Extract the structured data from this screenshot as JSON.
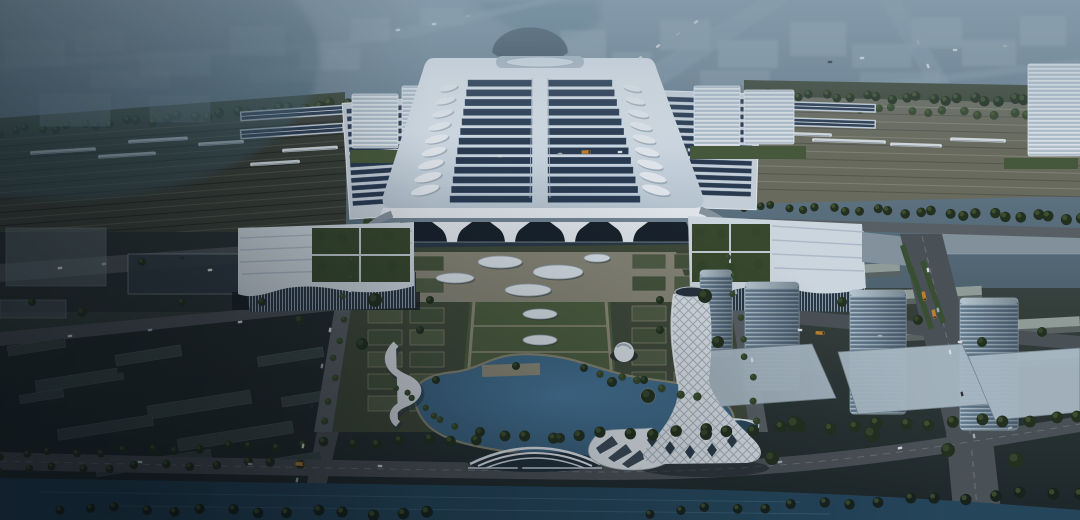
{
  "scene": {
    "label": "Aerial dusk rendering of a high-speed railway station: solar-panel hall roof, platform canopies with trains, formal forecourt gardens, lakeside park with spiral lattice tower, glass office towers and canal"
  },
  "palette": {
    "corridorL": "#3c4037",
    "corridorR": "#6f6f60",
    "trackA": "#5b5f50",
    "trackB": "#23261f",
    "trackC": "#8e8e7d",
    "trackD": "#57574b",
    "treeDark": "#24301d",
    "treeMid": "#36472a",
    "treeDeep": "#17211a",
    "roofLight": "#eef2f7",
    "roofShade": "#c2cfda",
    "panelDark": "#2b3b51",
    "panelLight": "#3d5472",
    "canopyFrame": "#d2dbe4",
    "fascia": "#eef2f6",
    "facadeDark": "#18212a",
    "glassDark": "#2a3845",
    "plazaBase": "#424b38",
    "hedge": "#535f44",
    "lawn": "#47553b",
    "pathTan": "#948e7a",
    "apron": "#8e8a79",
    "axisLawn": "#50603f",
    "ovalWhite": "#e4ebf0",
    "ovalRim": "#9aa8b2",
    "canal": "#26475c",
    "road": "#4e5357",
    "roadLight": "#5d6367",
    "lane": "#8f969b",
    "bldGrey": "#9aa49e",
    "bldGreySide": "#5d6763",
    "towerLight": "#c3d2db",
    "twist": "#e6ebf0",
    "lattice": "#8b98a4",
    "annexRoof": "#dbe3ea",
    "annexStripe": "#b9c6d3",
    "court": "#3a4a2c",
    "districtBox": "#3d4846",
    "districtBoxSide": "#242c2c",
    "carW": "#e2e7ea",
    "carS": "#aab4ba",
    "carD": "#2c3338",
    "bus": "#c8872f",
    "trainBody": "#dfe5e9",
    "trainLine": "#8b95a0",
    "bgBlock": "#a7b6c0",
    "bgRoad": "#8da2af",
    "shore": "#8d8a74"
  },
  "background": {
    "blocks": [
      [
        5,
        40,
        60,
        26,
        0.3
      ],
      [
        75,
        30,
        50,
        22,
        0.25
      ],
      [
        140,
        52,
        70,
        24,
        0.3
      ],
      [
        230,
        26,
        55,
        30,
        0.35
      ],
      [
        300,
        48,
        60,
        22,
        0.28
      ],
      [
        350,
        18,
        40,
        24,
        0.3
      ],
      [
        90,
        70,
        80,
        18,
        0.22
      ],
      [
        250,
        66,
        70,
        16,
        0.2
      ],
      [
        560,
        30,
        46,
        34,
        0.4
      ],
      [
        612,
        52,
        40,
        26,
        0.35
      ],
      [
        660,
        20,
        50,
        30,
        0.38
      ],
      [
        718,
        40,
        60,
        28,
        0.42
      ],
      [
        790,
        22,
        56,
        34,
        0.4
      ],
      [
        852,
        44,
        60,
        24,
        0.35
      ],
      [
        912,
        18,
        50,
        30,
        0.4
      ],
      [
        962,
        40,
        54,
        26,
        0.38
      ],
      [
        1020,
        16,
        46,
        30,
        0.4
      ],
      [
        700,
        70,
        70,
        16,
        0.3
      ],
      [
        860,
        72,
        80,
        14,
        0.28
      ],
      [
        420,
        8,
        44,
        18,
        0.3
      ]
    ],
    "roads": [
      "0,62 360,40 360,46 0,70",
      "370,34 540,0 560,0 400,40",
      "600,96 760,0 790,0 640,100",
      "640,112 1080,58 1080,66 660,116",
      "900,0 960,100 940,104 880,0"
    ]
  },
  "railway": {
    "trains": [
      [
        30,
        151,
        66,
        -3.5
      ],
      [
        98,
        155,
        58,
        -3.5
      ],
      [
        128,
        140,
        60,
        -3.5
      ],
      [
        198,
        143,
        46,
        -3.5
      ],
      [
        250,
        163,
        50,
        -3.5
      ],
      [
        282,
        149,
        56,
        -3.5
      ],
      [
        733,
        128,
        56,
        1.8
      ],
      [
        762,
        134,
        70,
        1.8
      ],
      [
        812,
        141,
        74,
        1.8
      ],
      [
        890,
        145,
        52,
        1.8
      ],
      [
        950,
        140,
        56,
        1.8
      ]
    ]
  },
  "station": {
    "roof_grid": {
      "rows": 13,
      "yTop": 80,
      "yBot": 196,
      "rowH": 6.4,
      "leftTop": 468,
      "leftBot": 450,
      "rightTop": 612,
      "rightBot": 640,
      "cx": 540,
      "spine": 8
    },
    "leaf": {
      "n": 9,
      "rx": 12,
      "ry": 3.6,
      "left": [
        448,
        88,
        425,
        190,
        -14
      ],
      "right": [
        632,
        88,
        656,
        190,
        14
      ]
    },
    "canopies": [
      {
        "x": 350,
        "y": 106,
        "w": 90,
        "rows": 13,
        "rowH": 4.4,
        "gap": 3.3,
        "rot": -3.8,
        "fx": 346,
        "fy": 100,
        "fw": 98,
        "fh": 116
      },
      {
        "x": 648,
        "y": 98,
        "w": 104,
        "rows": 13,
        "rowH": 4.4,
        "gap": 3.3,
        "rot": 1.8,
        "fx": 644,
        "fy": 92,
        "fw": 114,
        "fh": 116
      }
    ],
    "outer_strips": [
      [
        240,
        108,
        104,
        10,
        -3.8
      ],
      [
        240,
        126,
        104,
        10,
        -3.8
      ],
      [
        758,
        102,
        118,
        9,
        1.8
      ],
      [
        758,
        118,
        118,
        9,
        1.8
      ]
    ],
    "flank_slabs": [
      [
        352,
        94,
        46,
        54
      ],
      [
        402,
        86,
        42,
        62
      ],
      [
        694,
        86,
        46,
        60
      ],
      [
        744,
        90,
        50,
        54
      ],
      [
        1028,
        64,
        54,
        92
      ]
    ],
    "lawns": [
      [
        350,
        150,
        112,
        13
      ],
      [
        690,
        146,
        116,
        13
      ],
      [
        1004,
        158,
        74,
        11
      ]
    ],
    "pylons": [
      452,
      510,
      570,
      628
    ]
  },
  "plaza": {
    "ovals": [
      [
        500,
        262,
        22,
        6
      ],
      [
        558,
        272,
        25,
        7
      ],
      [
        455,
        278,
        19,
        5
      ],
      [
        528,
        290,
        23,
        6
      ],
      [
        597,
        258,
        13,
        4
      ]
    ],
    "axis_ovals": [
      [
        540,
        314,
        17,
        5
      ],
      [
        540,
        340,
        17,
        5
      ],
      [
        540,
        366,
        17,
        5
      ]
    ],
    "gardens": [
      [
        368,
        308,
        2,
        5
      ],
      [
        632,
        306,
        2,
        5
      ],
      [
        368,
        256,
        2,
        2
      ],
      [
        632,
        254,
        2,
        2
      ]
    ],
    "cell": {
      "cw": 34,
      "ch": 15,
      "gx": 8,
      "gy": 7
    }
  },
  "district": {
    "towers": [
      [
        700,
        270,
        32,
        86
      ],
      [
        745,
        282,
        54,
        108
      ],
      [
        850,
        290,
        56,
        124
      ],
      [
        960,
        298,
        58,
        132
      ]
    ],
    "podiums": [
      "688,352 812,344 836,398 700,408",
      "838,352 962,344 990,404 858,414",
      "968,356 1080,348 1080,412 995,420"
    ],
    "rows_ne": [
      [
        664,
        246,
        190,
        12
      ],
      [
        690,
        268,
        210,
        13
      ],
      [
        742,
        292,
        240,
        14
      ],
      [
        860,
        322,
        220,
        15
      ],
      [
        950,
        352,
        130,
        14
      ]
    ],
    "boxes_sw": [
      [
        36,
        374,
        88,
        20
      ],
      [
        116,
        350,
        66,
        18
      ],
      [
        148,
        398,
        104,
        22
      ],
      [
        58,
        422,
        96,
        18
      ],
      [
        178,
        430,
        116,
        20
      ],
      [
        258,
        352,
        66,
        16
      ],
      [
        282,
        392,
        70,
        16
      ],
      [
        8,
        342,
        58,
        16
      ],
      [
        96,
        458,
        116,
        16
      ],
      [
        236,
        458,
        86,
        14
      ],
      [
        20,
        392,
        44,
        14
      ]
    ],
    "midleft": [
      [
        6,
        228,
        100,
        58,
        "#6b7a80",
        0.55
      ],
      [
        128,
        254,
        148,
        40,
        "#323d44",
        0.9
      ],
      [
        0,
        300,
        66,
        18,
        "#55636a",
        0.6
      ],
      [
        40,
        94,
        70,
        32,
        "#8ca0ac",
        0.4
      ],
      [
        150,
        96,
        60,
        26,
        "#8ca0ac",
        0.3
      ],
      [
        940,
        230,
        148,
        24,
        "#97a3ab",
        0.8
      ]
    ],
    "medians": [
      "908,268 913,266 934,328 929,330",
      "920,262 925,260 946,322 941,324",
      "900,246 905,244 914,272 909,274"
    ]
  },
  "greenery": {
    "bands_north": [
      [
        0,
        132,
        346,
        104,
        26,
        5,
        "#24301d"
      ],
      [
        744,
        94,
        1080,
        102,
        26,
        5,
        "#24301d"
      ],
      [
        860,
        108,
        1080,
        118,
        14,
        5,
        "#36472a"
      ],
      [
        744,
        206,
        1080,
        218,
        24,
        5,
        "#24301d"
      ]
    ],
    "bands_south": [
      [
        0,
        455,
        1080,
        418,
        44,
        5,
        "#24301d"
      ],
      [
        0,
        470,
        300,
        462,
        12,
        5,
        "#24301d"
      ],
      [
        60,
        508,
        430,
        514,
        14,
        6,
        "#17211a"
      ],
      [
        650,
        512,
        1080,
        492,
        16,
        6,
        "#17211a"
      ],
      [
        352,
        258,
        326,
        420,
        9,
        4,
        "#36472a"
      ],
      [
        728,
        255,
        758,
        420,
        9,
        4,
        "#36472a"
      ],
      [
        396,
        386,
        452,
        428,
        7,
        4,
        "#36472a"
      ],
      [
        600,
        372,
        700,
        398,
        6,
        5,
        "#36472a"
      ]
    ],
    "clusters_north": [
      [
        366,
        156,
        3
      ],
      [
        398,
        156,
        3
      ],
      [
        700,
        152,
        3
      ],
      [
        736,
        152,
        3
      ],
      [
        760,
        152,
        3
      ],
      [
        430,
        158,
        3
      ],
      [
        368,
        222,
        5
      ],
      [
        712,
        218,
        5
      ]
    ],
    "clusters_south": [
      [
        375,
        300,
        7
      ],
      [
        705,
        296,
        7
      ],
      [
        362,
        344,
        6
      ],
      [
        718,
        342,
        6
      ],
      [
        648,
        396,
        7
      ],
      [
        612,
        382,
        5
      ],
      [
        795,
        424,
        8
      ],
      [
        706,
        434,
        6
      ],
      [
        872,
        434,
        8
      ],
      [
        948,
        450,
        7
      ],
      [
        1016,
        460,
        8
      ],
      [
        772,
        458,
        7
      ],
      [
        842,
        302,
        5
      ],
      [
        918,
        320,
        5
      ],
      [
        300,
        320,
        5
      ],
      [
        262,
        302,
        4
      ],
      [
        182,
        302,
        4
      ],
      [
        82,
        312,
        5
      ],
      [
        32,
        302,
        4
      ],
      [
        142,
        262,
        4
      ],
      [
        982,
        342,
        5
      ],
      [
        1042,
        332,
        5
      ],
      [
        480,
        432,
        5
      ],
      [
        560,
        438,
        5
      ],
      [
        430,
        300,
        4
      ],
      [
        660,
        300,
        4
      ],
      [
        516,
        366,
        4
      ],
      [
        584,
        368,
        4
      ],
      [
        420,
        330,
        4
      ],
      [
        436,
        380,
        4
      ],
      [
        660,
        330,
        4
      ],
      [
        644,
        380,
        4
      ]
    ]
  },
  "traffic": {
    "cars": [
      [
        398,
        30,
        -8,
        "w"
      ],
      [
        434,
        24,
        -8,
        "w"
      ],
      [
        468,
        16,
        -8,
        "s"
      ],
      [
        640,
        58,
        -35,
        "w"
      ],
      [
        658,
        46,
        -35,
        "w"
      ],
      [
        678,
        34,
        -35,
        "s"
      ],
      [
        696,
        22,
        -35,
        "w"
      ],
      [
        830,
        62,
        -4,
        "d"
      ],
      [
        862,
        58,
        -4,
        "w"
      ],
      [
        918,
        42,
        70,
        "s"
      ],
      [
        928,
        66,
        70,
        "w"
      ],
      [
        955,
        50,
        -4,
        "w"
      ],
      [
        1005,
        46,
        -4,
        "s"
      ],
      [
        500,
        156,
        -2,
        "w"
      ],
      [
        560,
        154,
        -2,
        "s"
      ],
      [
        620,
        152,
        -2,
        "w"
      ],
      [
        60,
        268,
        -5,
        "w"
      ],
      [
        104,
        264,
        -5,
        "s"
      ],
      [
        182,
        258,
        -5,
        "d"
      ],
      [
        262,
        252,
        -5,
        "w"
      ],
      [
        210,
        270,
        -5,
        "w"
      ],
      [
        330,
        330,
        -80,
        "w"
      ],
      [
        322,
        366,
        -80,
        "s"
      ],
      [
        312,
        406,
        -80,
        "d"
      ],
      [
        303,
        446,
        -80,
        "w"
      ],
      [
        297,
        480,
        -80,
        "s"
      ],
      [
        70,
        336,
        -6,
        "w"
      ],
      [
        150,
        330,
        -6,
        "s"
      ],
      [
        240,
        322,
        -6,
        "w"
      ],
      [
        350,
        290,
        -80,
        "w"
      ],
      [
        736,
        292,
        80,
        "s"
      ],
      [
        752,
        360,
        80,
        "w"
      ],
      [
        800,
        330,
        4,
        "w"
      ],
      [
        880,
        336,
        4,
        "s"
      ],
      [
        960,
        342,
        4,
        "w"
      ],
      [
        928,
        270,
        78,
        "w"
      ],
      [
        938,
        310,
        78,
        "s"
      ],
      [
        950,
        352,
        78,
        "w"
      ],
      [
        962,
        394,
        78,
        "d"
      ],
      [
        974,
        436,
        80,
        "s"
      ],
      [
        140,
        462,
        2,
        "w"
      ],
      [
        250,
        464,
        2,
        "s"
      ],
      [
        380,
        466,
        1,
        "w"
      ],
      [
        520,
        468,
        0,
        "d"
      ],
      [
        640,
        468,
        -2,
        "w"
      ],
      [
        780,
        462,
        -8,
        "s"
      ],
      [
        900,
        448,
        -12,
        "w"
      ],
      [
        1010,
        428,
        -14,
        "s"
      ]
    ],
    "buses": [
      [
        924,
        296,
        78
      ],
      [
        934,
        314,
        78
      ],
      [
        820,
        333,
        4
      ],
      [
        586,
        152,
        -2
      ],
      [
        300,
        464,
        2
      ]
    ]
  }
}
